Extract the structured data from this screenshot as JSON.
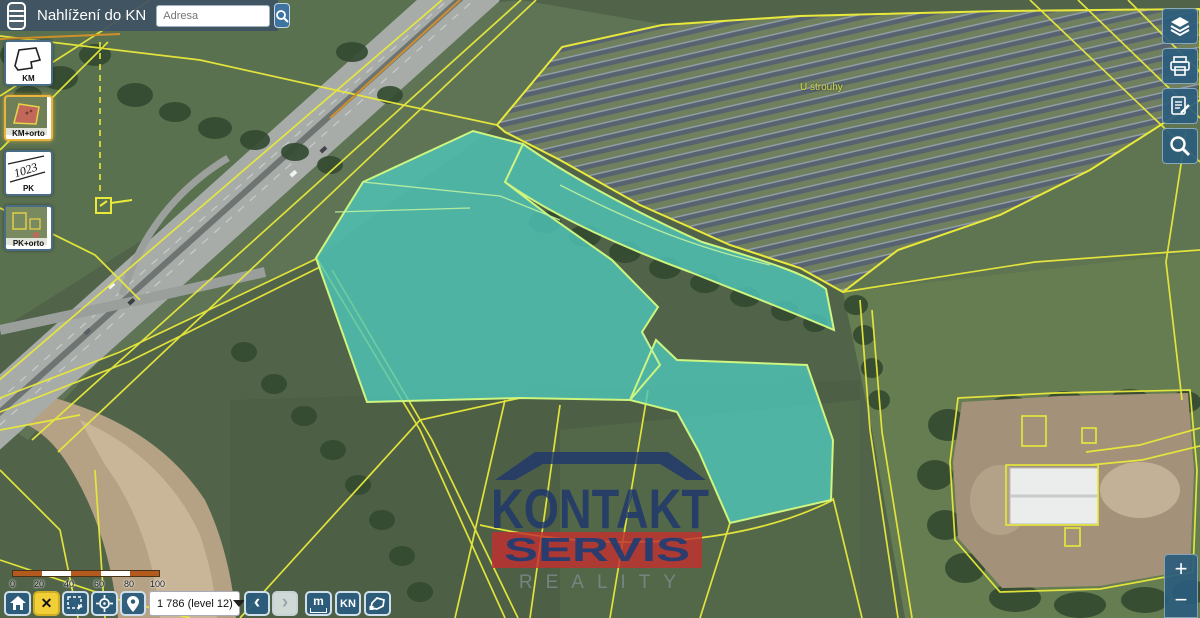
{
  "app": {
    "title": "Nahlížení do KN"
  },
  "header": {
    "search_placeholder": "Adresa"
  },
  "layer_switcher": {
    "buttons": [
      {
        "label": "KM",
        "selected": false
      },
      {
        "label": "KM+orto",
        "selected": true
      },
      {
        "label": "PK",
        "selected": false
      },
      {
        "label": "PK+orto",
        "selected": false
      }
    ],
    "pk_thumb_text": "1023"
  },
  "right_toolbar": {
    "buttons": [
      {
        "icon": "layers"
      },
      {
        "icon": "printer"
      },
      {
        "icon": "report-pencil"
      },
      {
        "icon": "magnifier"
      }
    ]
  },
  "map": {
    "place_label": "U strouhy",
    "watermark": {
      "line1": "KONTAKT",
      "line2": "SERVIS",
      "line3": "REALITY"
    },
    "colors": {
      "highlight_fill": "#4fc7ba",
      "highlight_edge": "#cdf57f",
      "parcel_line": "#e9e93b",
      "accent_orange": "#cf8f2a"
    }
  },
  "scalebar": {
    "tick_labels": [
      "0",
      "20",
      "40",
      "60",
      "80"
    ],
    "end_label": "100 m"
  },
  "bottom_toolbar": {
    "clear_label": "✕",
    "level_select_value": "1 786 (level 12)",
    "back_glyph": "‹",
    "forward_glyph": "›",
    "measure_label": "m",
    "kn_label": "KN"
  },
  "zoom_controls": {
    "zoom_in_label": "+",
    "zoom_out_label": "−"
  }
}
